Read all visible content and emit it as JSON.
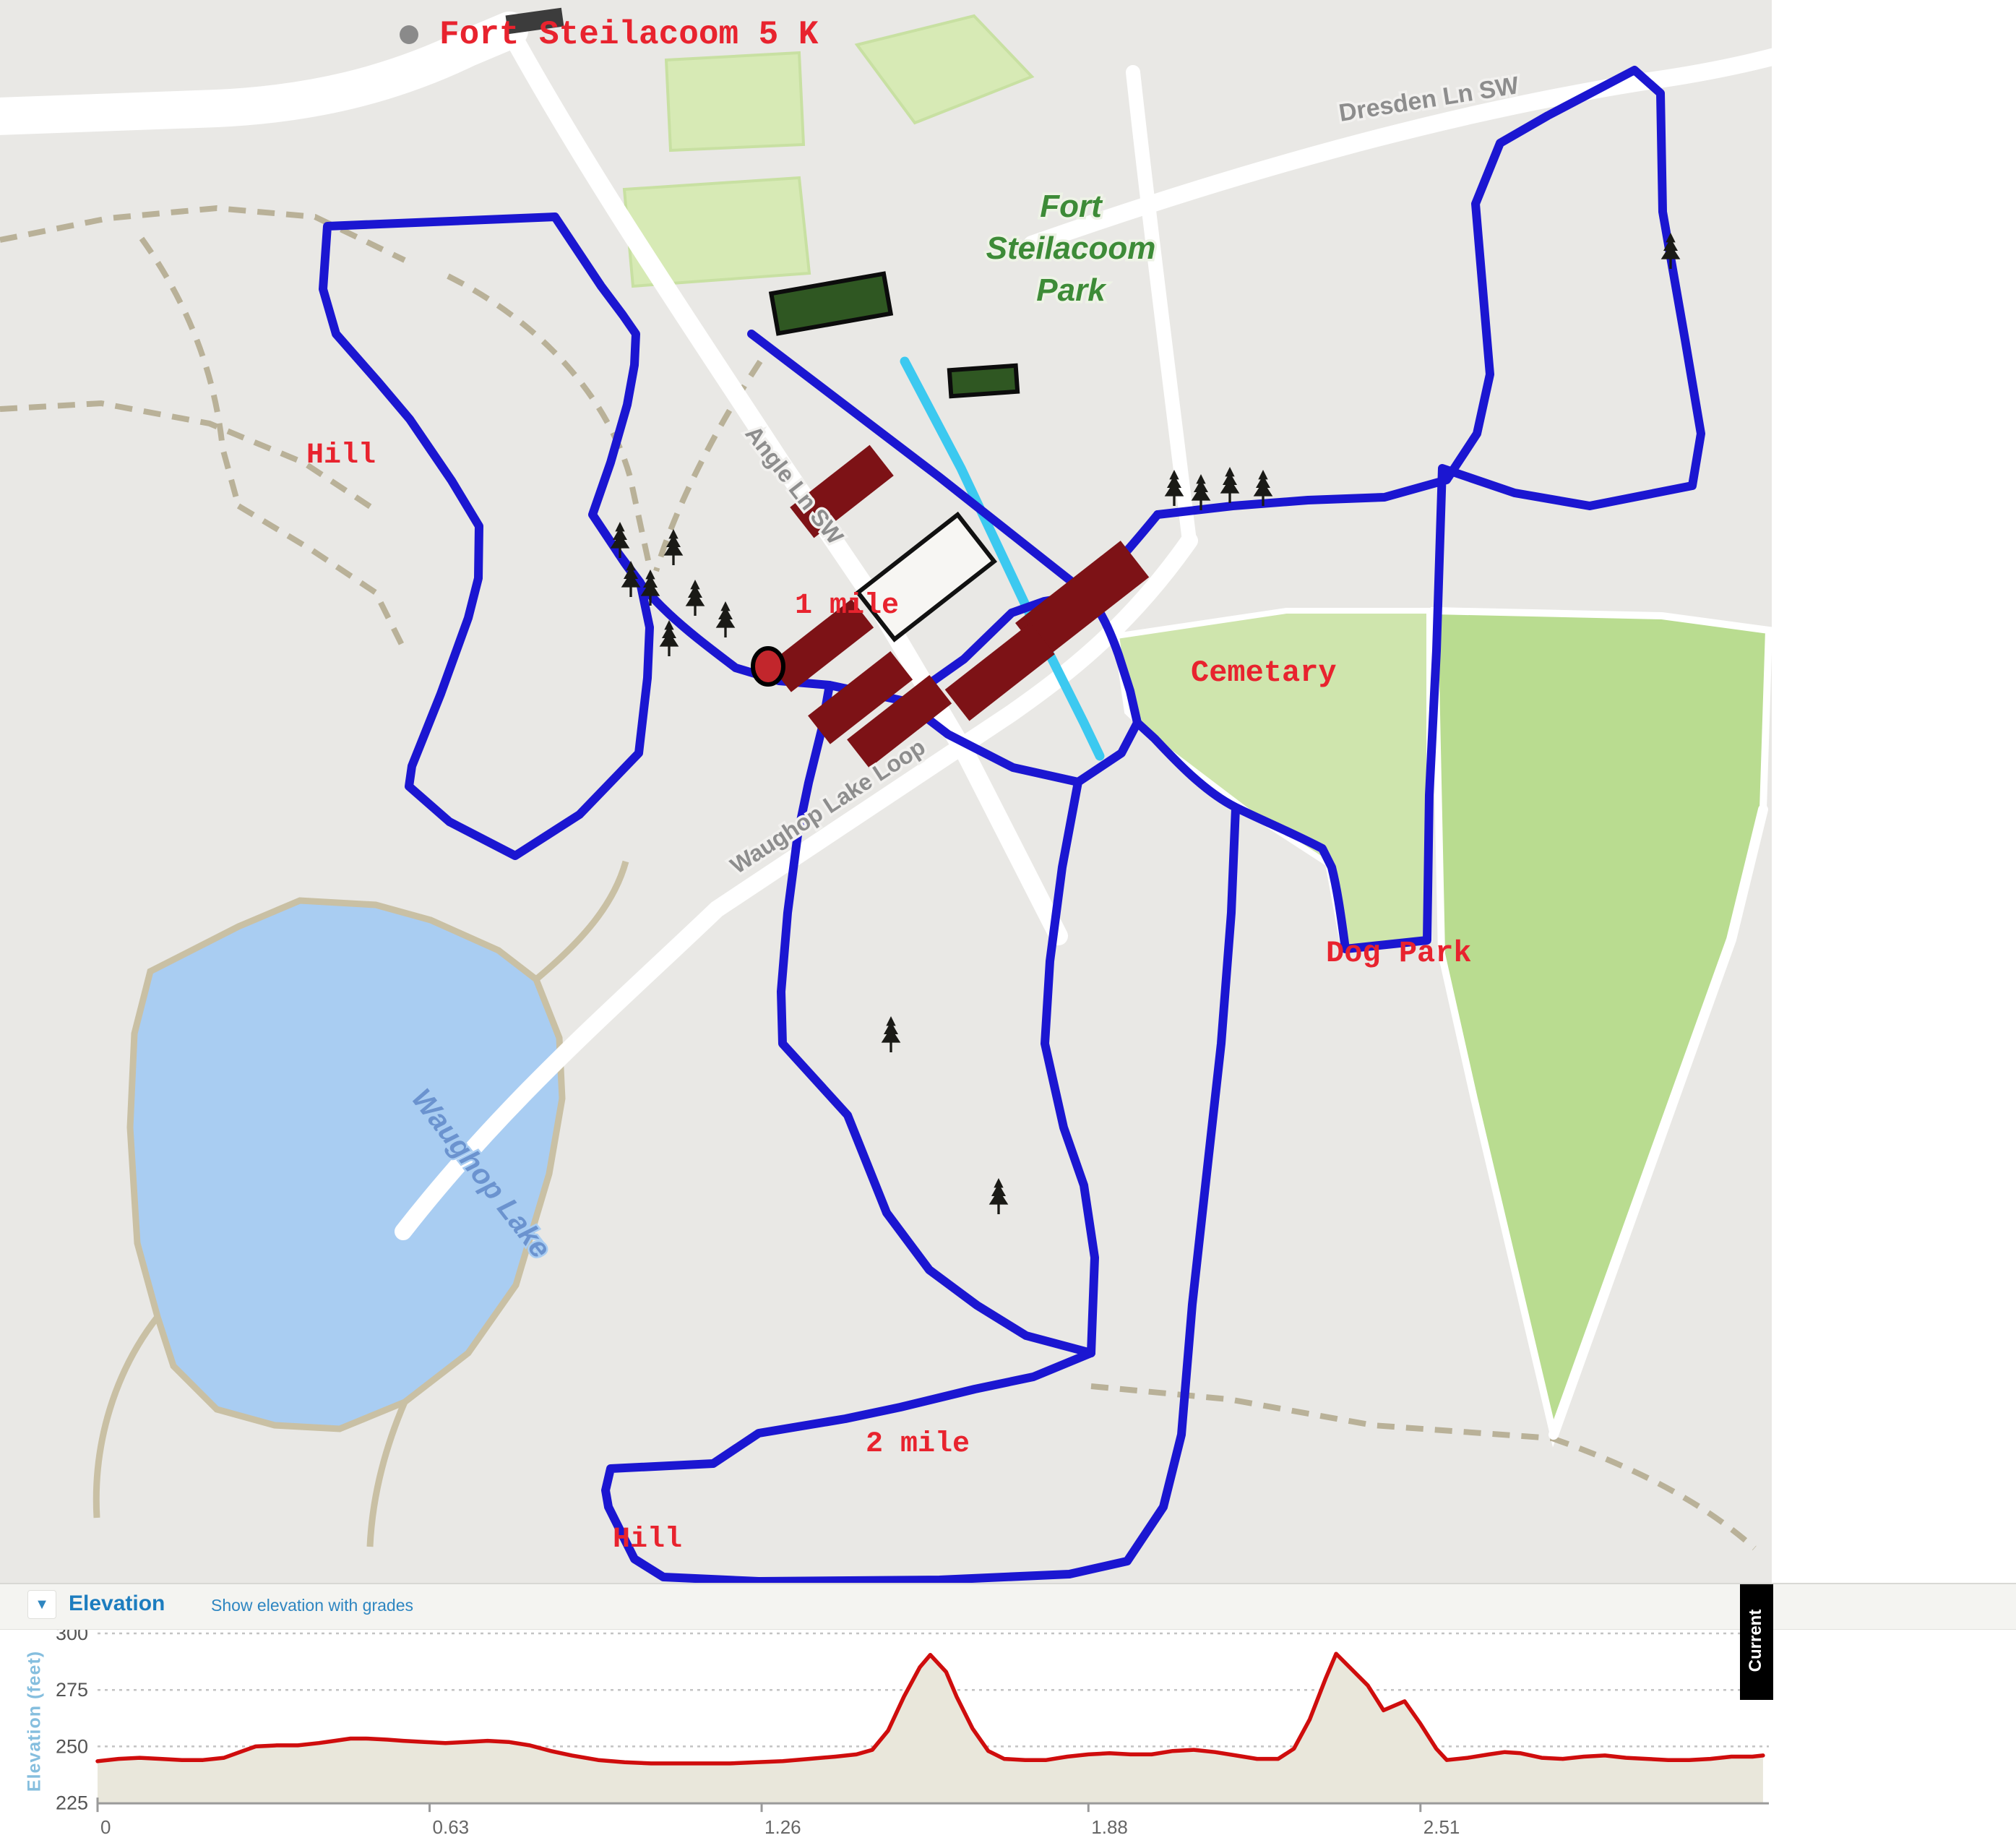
{
  "map": {
    "title": "Fort Steilacoom 5 K",
    "annotations": {
      "hill_nw": "Hill",
      "mile_1": "1 mile",
      "cemetery": "Cemetary",
      "dog_park": "Dog Park",
      "mile_2": "2 mile",
      "hill_s": "Hill"
    },
    "road_labels": {
      "dresden": "Dresden Ln SW",
      "angle": "Angle Ln SW",
      "waughop_loop": "Waughop Lake Loop"
    },
    "place_labels": {
      "park_line1": "Fort",
      "park_line2": "Steilacoom",
      "park_line3": "Park",
      "lake": "Waughop Lake"
    },
    "colors": {
      "route_blue": "#1b16d1",
      "creek_cyan": "#3cc9f0",
      "annotation_red": "#e8232e",
      "building_red": "#7d1216",
      "field_green": "#d7eab5",
      "cemetery_green": "#cfe5ad",
      "dogpark_green": "#b9dc90",
      "water_blue": "#a9cdf2",
      "map_bg": "#e9e8e5"
    }
  },
  "elevation": {
    "header": "Elevation",
    "link": "Show elevation with grades",
    "y_axis_label": "Elevation (feet)",
    "overlay_label": "Current",
    "y_ticks": [
      300,
      275,
      250,
      225
    ],
    "x_ticks": [
      0,
      0.63,
      1.26,
      1.88,
      2.51
    ]
  },
  "chart_data": {
    "type": "area",
    "title": "Elevation profile",
    "xlabel": "Distance (miles)",
    "ylabel": "Elevation (feet)",
    "xlim": [
      0,
      3.16
    ],
    "ylim": [
      225,
      300
    ],
    "grid_y_values": [
      300,
      275,
      250
    ],
    "line_color": "#cf0d0d",
    "fill_color": "#e9e7db",
    "series": [
      {
        "name": "Elevation (feet)",
        "points": [
          [
            0,
            243.5
          ],
          [
            0.04,
            244.5
          ],
          [
            0.08,
            245
          ],
          [
            0.12,
            244.5
          ],
          [
            0.16,
            244
          ],
          [
            0.2,
            244
          ],
          [
            0.24,
            245
          ],
          [
            0.27,
            247.5
          ],
          [
            0.3,
            250
          ],
          [
            0.34,
            250.5
          ],
          [
            0.38,
            250.5
          ],
          [
            0.42,
            251.5
          ],
          [
            0.45,
            252.5
          ],
          [
            0.48,
            253.5
          ],
          [
            0.51,
            253.5
          ],
          [
            0.55,
            253
          ],
          [
            0.58,
            252.5
          ],
          [
            0.62,
            252
          ],
          [
            0.66,
            251.5
          ],
          [
            0.7,
            252
          ],
          [
            0.74,
            252.5
          ],
          [
            0.78,
            252
          ],
          [
            0.82,
            250.5
          ],
          [
            0.86,
            248
          ],
          [
            0.9,
            246
          ],
          [
            0.95,
            244
          ],
          [
            1.0,
            243
          ],
          [
            1.05,
            242.5
          ],
          [
            1.1,
            242.5
          ],
          [
            1.15,
            242.5
          ],
          [
            1.2,
            242.5
          ],
          [
            1.25,
            243
          ],
          [
            1.3,
            243.5
          ],
          [
            1.35,
            244.5
          ],
          [
            1.4,
            245.5
          ],
          [
            1.44,
            246.5
          ],
          [
            1.47,
            248.5
          ],
          [
            1.5,
            257
          ],
          [
            1.53,
            272
          ],
          [
            1.56,
            285
          ],
          [
            1.58,
            290.5
          ],
          [
            1.61,
            283
          ],
          [
            1.63,
            272
          ],
          [
            1.66,
            258
          ],
          [
            1.69,
            248
          ],
          [
            1.72,
            244.5
          ],
          [
            1.76,
            244
          ],
          [
            1.8,
            244
          ],
          [
            1.84,
            245.5
          ],
          [
            1.88,
            246.5
          ],
          [
            1.92,
            247
          ],
          [
            1.96,
            246.5
          ],
          [
            2.0,
            246.5
          ],
          [
            2.04,
            248
          ],
          [
            2.08,
            248.5
          ],
          [
            2.12,
            247.5
          ],
          [
            2.16,
            246
          ],
          [
            2.2,
            244.5
          ],
          [
            2.24,
            244.5
          ],
          [
            2.27,
            249
          ],
          [
            2.3,
            262
          ],
          [
            2.33,
            280
          ],
          [
            2.35,
            291
          ],
          [
            2.38,
            284
          ],
          [
            2.41,
            277
          ],
          [
            2.44,
            266
          ],
          [
            2.46,
            268
          ],
          [
            2.48,
            270
          ],
          [
            2.51,
            260
          ],
          [
            2.54,
            249
          ],
          [
            2.56,
            244
          ],
          [
            2.6,
            245
          ],
          [
            2.64,
            246.5
          ],
          [
            2.67,
            247.5
          ],
          [
            2.7,
            247
          ],
          [
            2.74,
            245
          ],
          [
            2.78,
            244.5
          ],
          [
            2.82,
            245.5
          ],
          [
            2.86,
            246
          ],
          [
            2.9,
            245
          ],
          [
            2.94,
            244.5
          ],
          [
            2.98,
            244
          ],
          [
            3.02,
            244
          ],
          [
            3.06,
            244.5
          ],
          [
            3.1,
            245.5
          ],
          [
            3.14,
            245.5
          ],
          [
            3.16,
            246
          ]
        ]
      }
    ]
  }
}
